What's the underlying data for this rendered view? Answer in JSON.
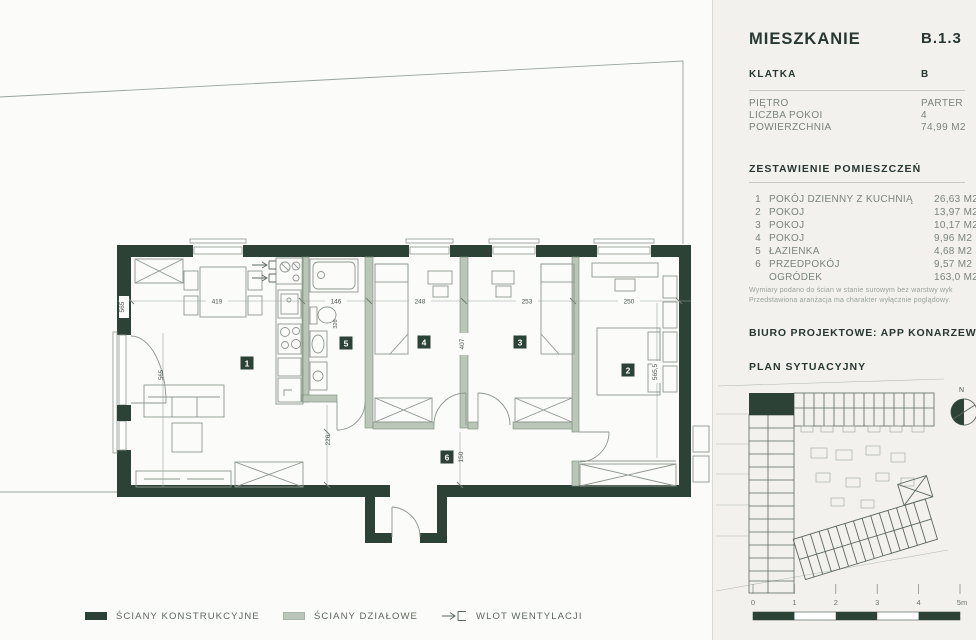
{
  "panel": {
    "title": {
      "label": "MIESZKANIE",
      "value": "B.1.3"
    },
    "klatka": {
      "label": "KLATKA",
      "value": "B"
    },
    "info_rows": [
      {
        "label": "PIĘTRO",
        "value": "PARTER"
      },
      {
        "label": "LICZBA POKOI",
        "value": "4"
      },
      {
        "label": "POWIERZCHNIA",
        "value": "74,99 M2"
      }
    ],
    "rooms_header": "ZESTAWIENIE POMIESZCZEŃ",
    "rooms": [
      {
        "num": "1",
        "name": "POKÓJ DZIENNY Z KUCHNIĄ",
        "area": "26,63 M2"
      },
      {
        "num": "2",
        "name": "POKOJ",
        "area": "13,97 M2"
      },
      {
        "num": "3",
        "name": "POKOJ",
        "area": "10,17 M2"
      },
      {
        "num": "4",
        "name": "POKOJ",
        "area": "9,96 M2"
      },
      {
        "num": "5",
        "name": "ŁAZIENKA",
        "area": "4,68 M2"
      },
      {
        "num": "6",
        "name": "PRZEDPOKÓJ",
        "area": "9,57 M2"
      },
      {
        "num": "",
        "name": "OGRÓDEK",
        "area": "163,0 M2"
      }
    ],
    "note_line1": "Wymiary podano do ścian w stanie surowym bez warstwy wyk",
    "note_line2": "Przedstawiona aranżacja ma charakter wyłącznie poglądowy.",
    "biuro": "BIURO PROJEKTOWE: APP KONARZEWSKI",
    "siteplan_header": "PLAN SYTUACYJNY",
    "compass": "N",
    "scale_labels": [
      "0",
      "1",
      "2",
      "3",
      "4",
      "5m"
    ]
  },
  "plan": {
    "badges": [
      "1",
      "2",
      "3",
      "4",
      "5",
      "6"
    ],
    "dims": {
      "living_w": "419",
      "bath_w": "146",
      "room4_w": "248",
      "room3_w": "253",
      "room2_w": "250",
      "living_h": "565",
      "bath_h": "326",
      "rooms_h": "407",
      "room2_h": "565,5",
      "hall_h": "226",
      "hall2_h": "150"
    }
  },
  "legend": {
    "items": [
      {
        "label": "ŚCIANY KONSTRUKCYJNE"
      },
      {
        "label": "ŚCIANY DZIAŁOWE"
      },
      {
        "label": "WLOT WENTYLACJI"
      }
    ]
  },
  "colors": {
    "wall": "#2d4237",
    "partition": "#bac7b8",
    "background": "#fbfbf9",
    "panel_bg": "#f2f1ee",
    "text_dark": "#273731",
    "text_gray": "#7b837d"
  }
}
